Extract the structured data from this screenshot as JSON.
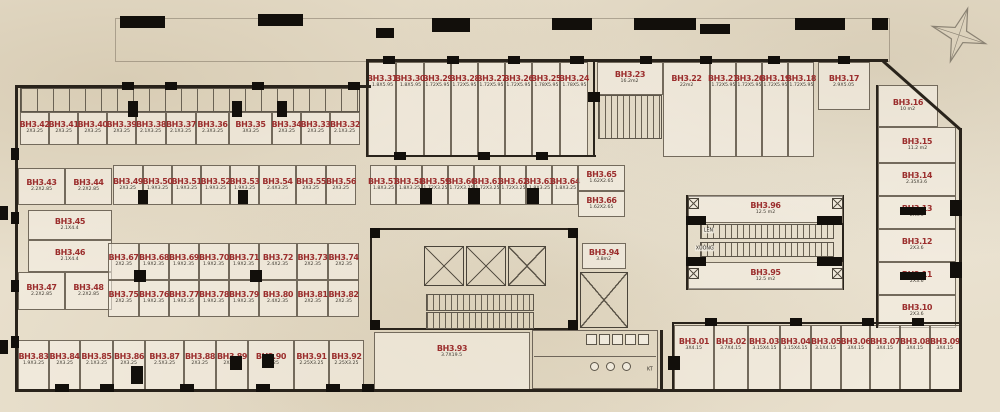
{
  "plan_name": "basement-storage-floor-plan",
  "colors": {
    "unit_label": "#9b2e2d",
    "dim_label": "#3d382f",
    "wall": "#29231b",
    "paper": "#e8dfcc"
  },
  "labels": {
    "escalator_up": "LÊN",
    "escalator_down": "XUỐNG",
    "kt": "KT"
  },
  "units": [
    {
      "id": "BH3.31",
      "dim": "1.8X5.95",
      "x": 368,
      "y": 62,
      "w": 28,
      "h": 95
    },
    {
      "id": "BH3.30",
      "dim": "1.8X5.95",
      "x": 396,
      "y": 62,
      "w": 28,
      "h": 95
    },
    {
      "id": "BH3.29",
      "dim": "1.72X5.95",
      "x": 424,
      "y": 62,
      "w": 27,
      "h": 95
    },
    {
      "id": "BH3.28",
      "dim": "1.72X5.95",
      "x": 451,
      "y": 62,
      "w": 27,
      "h": 95
    },
    {
      "id": "BH3.27",
      "dim": "1.72X5.95",
      "x": 478,
      "y": 62,
      "w": 27,
      "h": 95
    },
    {
      "id": "BH3.26",
      "dim": "1.72X5.95",
      "x": 505,
      "y": 62,
      "w": 27,
      "h": 95
    },
    {
      "id": "BH3.25",
      "dim": "1.78X5.95",
      "x": 532,
      "y": 62,
      "w": 28,
      "h": 95
    },
    {
      "id": "BH3.24",
      "dim": "1.78X5.95",
      "x": 560,
      "y": 62,
      "w": 28,
      "h": 95
    },
    {
      "id": "BH3.23",
      "dim": "16.2m2",
      "x": 597,
      "y": 62,
      "w": 66,
      "h": 33
    },
    {
      "id": "BH3.22",
      "dim": "22m2",
      "x": 663,
      "y": 62,
      "w": 47,
      "h": 95
    },
    {
      "id": "BH3.21",
      "dim": "1.72X5.95",
      "x": 710,
      "y": 62,
      "w": 26,
      "h": 95
    },
    {
      "id": "BH3.20",
      "dim": "1.72X5.95",
      "x": 736,
      "y": 62,
      "w": 26,
      "h": 95
    },
    {
      "id": "BH3.19",
      "dim": "1.72X5.95",
      "x": 762,
      "y": 62,
      "w": 26,
      "h": 95
    },
    {
      "id": "BH3.18",
      "dim": "1.72X5.95",
      "x": 788,
      "y": 62,
      "w": 26,
      "h": 95
    },
    {
      "id": "BH3.17",
      "dim": "2.9X5.05",
      "x": 818,
      "y": 62,
      "w": 52,
      "h": 48
    },
    {
      "id": "BH3.16",
      "dim": "10 m2",
      "x": 878,
      "y": 85,
      "w": 60,
      "h": 42
    },
    {
      "id": "BH3.15",
      "dim": "11.2 m2",
      "x": 878,
      "y": 127,
      "w": 78,
      "h": 36
    },
    {
      "id": "BH3.14",
      "dim": "2.35X3.6",
      "x": 878,
      "y": 163,
      "w": 78,
      "h": 33
    },
    {
      "id": "BH3.13",
      "dim": "2X3.6",
      "x": 878,
      "y": 196,
      "w": 78,
      "h": 33
    },
    {
      "id": "BH3.12",
      "dim": "2X3.6",
      "x": 878,
      "y": 229,
      "w": 78,
      "h": 33
    },
    {
      "id": "BH3.11",
      "dim": "2X3.6",
      "x": 878,
      "y": 262,
      "w": 78,
      "h": 33
    },
    {
      "id": "BH3.10",
      "dim": "2X3.6",
      "x": 878,
      "y": 295,
      "w": 78,
      "h": 33
    },
    {
      "id": "BH3.42",
      "dim": "2X3.25",
      "x": 20,
      "y": 112,
      "w": 29,
      "h": 33
    },
    {
      "id": "BH3.41",
      "dim": "2X3.25",
      "x": 49,
      "y": 112,
      "w": 29,
      "h": 33
    },
    {
      "id": "BH3.40",
      "dim": "2X3.25",
      "x": 78,
      "y": 112,
      "w": 29,
      "h": 33
    },
    {
      "id": "BH3.39",
      "dim": "2X3.25",
      "x": 107,
      "y": 112,
      "w": 29,
      "h": 33
    },
    {
      "id": "BH3.38",
      "dim": "2.1X3.25",
      "x": 136,
      "y": 112,
      "w": 30,
      "h": 33
    },
    {
      "id": "BH3.37",
      "dim": "2.1X3.25",
      "x": 166,
      "y": 112,
      "w": 30,
      "h": 33
    },
    {
      "id": "BH3.36",
      "dim": "2.3X3.25",
      "x": 196,
      "y": 112,
      "w": 33,
      "h": 33
    },
    {
      "id": "BH3.35",
      "dim": "3X3.25",
      "x": 229,
      "y": 112,
      "w": 43,
      "h": 33
    },
    {
      "id": "BH3.34",
      "dim": "2X3.25",
      "x": 272,
      "y": 112,
      "w": 29,
      "h": 33
    },
    {
      "id": "BH3.33",
      "dim": "2X3.25",
      "x": 301,
      "y": 112,
      "w": 29,
      "h": 33
    },
    {
      "id": "BH3.32",
      "dim": "2.1X3.25",
      "x": 330,
      "y": 112,
      "w": 30,
      "h": 33
    },
    {
      "id": "BH3.43",
      "dim": "2.2X2.85",
      "x": 18,
      "y": 168,
      "w": 47,
      "h": 37
    },
    {
      "id": "BH3.44",
      "dim": "2.2X2.85",
      "x": 65,
      "y": 168,
      "w": 47,
      "h": 37
    },
    {
      "id": "BH3.45",
      "dim": "2.1X4.4",
      "x": 28,
      "y": 210,
      "w": 84,
      "h": 30
    },
    {
      "id": "BH3.46",
      "dim": "2.1X4.4",
      "x": 28,
      "y": 240,
      "w": 84,
      "h": 32
    },
    {
      "id": "BH3.47",
      "dim": "2.2X2.85",
      "x": 18,
      "y": 272,
      "w": 47,
      "h": 38
    },
    {
      "id": "BH3.48",
      "dim": "2.2X2.85",
      "x": 65,
      "y": 272,
      "w": 47,
      "h": 38
    },
    {
      "id": "BH3.49",
      "dim": "2X3.25",
      "x": 113,
      "y": 165,
      "w": 30,
      "h": 40
    },
    {
      "id": "BH3.50",
      "dim": "1.9X3.25",
      "x": 143,
      "y": 165,
      "w": 29,
      "h": 40
    },
    {
      "id": "BH3.51",
      "dim": "1.9X3.25",
      "x": 172,
      "y": 165,
      "w": 29,
      "h": 40
    },
    {
      "id": "BH3.52",
      "dim": "1.9X3.25",
      "x": 201,
      "y": 165,
      "w": 29,
      "h": 40
    },
    {
      "id": "BH3.53",
      "dim": "1.9X3.25",
      "x": 230,
      "y": 165,
      "w": 29,
      "h": 40
    },
    {
      "id": "BH3.54",
      "dim": "2.4X3.25",
      "x": 259,
      "y": 165,
      "w": 37,
      "h": 40
    },
    {
      "id": "BH3.55",
      "dim": "2X3.25",
      "x": 296,
      "y": 165,
      "w": 30,
      "h": 40
    },
    {
      "id": "BH3.56",
      "dim": "2X3.25",
      "x": 326,
      "y": 165,
      "w": 30,
      "h": 40
    },
    {
      "id": "BH3.57",
      "dim": "1.8X3.25",
      "x": 370,
      "y": 165,
      "w": 26,
      "h": 40
    },
    {
      "id": "BH3.58",
      "dim": "1.8X3.25",
      "x": 396,
      "y": 165,
      "w": 26,
      "h": 40
    },
    {
      "id": "BH3.59",
      "dim": "1.72X3.25",
      "x": 422,
      "y": 165,
      "w": 26,
      "h": 40
    },
    {
      "id": "BH3.60",
      "dim": "1.72X3.25",
      "x": 448,
      "y": 165,
      "w": 26,
      "h": 40
    },
    {
      "id": "BH3.61",
      "dim": "1.72X3.25",
      "x": 474,
      "y": 165,
      "w": 26,
      "h": 40
    },
    {
      "id": "BH3.62",
      "dim": "1.72X3.25",
      "x": 500,
      "y": 165,
      "w": 26,
      "h": 40
    },
    {
      "id": "BH3.63",
      "dim": "1.8X3.25",
      "x": 526,
      "y": 165,
      "w": 26,
      "h": 40
    },
    {
      "id": "BH3.64",
      "dim": "1.8X3.25",
      "x": 552,
      "y": 165,
      "w": 26,
      "h": 40
    },
    {
      "id": "BH3.65",
      "dim": "1.62X2.65",
      "x": 578,
      "y": 165,
      "w": 47,
      "h": 26
    },
    {
      "id": "BH3.66",
      "dim": "1.62X2.65",
      "x": 578,
      "y": 191,
      "w": 47,
      "h": 26
    },
    {
      "id": "BH3.67",
      "dim": "2X2.35",
      "x": 108,
      "y": 243,
      "w": 31,
      "h": 37
    },
    {
      "id": "BH3.68",
      "dim": "1.9X2.35",
      "x": 139,
      "y": 243,
      "w": 30,
      "h": 37
    },
    {
      "id": "BH3.69",
      "dim": "1.9X2.35",
      "x": 169,
      "y": 243,
      "w": 30,
      "h": 37
    },
    {
      "id": "BH3.70",
      "dim": "1.9X2.35",
      "x": 199,
      "y": 243,
      "w": 30,
      "h": 37
    },
    {
      "id": "BH3.71",
      "dim": "1.9X2.35",
      "x": 229,
      "y": 243,
      "w": 30,
      "h": 37
    },
    {
      "id": "BH3.72",
      "dim": "2.4X2.35",
      "x": 259,
      "y": 243,
      "w": 38,
      "h": 37
    },
    {
      "id": "BH3.73",
      "dim": "2X2.35",
      "x": 297,
      "y": 243,
      "w": 31,
      "h": 37
    },
    {
      "id": "BH3.74",
      "dim": "2X2.35",
      "x": 328,
      "y": 243,
      "w": 31,
      "h": 37
    },
    {
      "id": "BH3.75",
      "dim": "2X2.35",
      "x": 108,
      "y": 280,
      "w": 31,
      "h": 37
    },
    {
      "id": "BH3.76",
      "dim": "1.9X2.35",
      "x": 139,
      "y": 280,
      "w": 30,
      "h": 37
    },
    {
      "id": "BH3.77",
      "dim": "1.9X2.35",
      "x": 169,
      "y": 280,
      "w": 30,
      "h": 37
    },
    {
      "id": "BH3.78",
      "dim": "1.9X2.35",
      "x": 199,
      "y": 280,
      "w": 30,
      "h": 37
    },
    {
      "id": "BH3.79",
      "dim": "1.9X2.35",
      "x": 229,
      "y": 280,
      "w": 30,
      "h": 37
    },
    {
      "id": "BH3.80",
      "dim": "2.4X2.35",
      "x": 259,
      "y": 280,
      "w": 38,
      "h": 37
    },
    {
      "id": "BH3.81",
      "dim": "2X2.35",
      "x": 297,
      "y": 280,
      "w": 31,
      "h": 37
    },
    {
      "id": "BH3.82",
      "dim": "2X2.35",
      "x": 328,
      "y": 280,
      "w": 31,
      "h": 37
    },
    {
      "id": "BH3.83",
      "dim": "1.9X3.25",
      "x": 18,
      "y": 340,
      "w": 31,
      "h": 50
    },
    {
      "id": "BH3.84",
      "dim": "2X3.25",
      "x": 49,
      "y": 340,
      "w": 31,
      "h": 50
    },
    {
      "id": "BH3.85",
      "dim": "2.1X3.25",
      "x": 80,
      "y": 340,
      "w": 33,
      "h": 50
    },
    {
      "id": "BH3.86",
      "dim": "2X3.25",
      "x": 113,
      "y": 340,
      "w": 32,
      "h": 50
    },
    {
      "id": "BH3.87",
      "dim": "2.5X3.25",
      "x": 145,
      "y": 340,
      "w": 39,
      "h": 50
    },
    {
      "id": "BH3.88",
      "dim": "2X3.25",
      "x": 184,
      "y": 340,
      "w": 32,
      "h": 50
    },
    {
      "id": "BH3.89",
      "dim": "2X3.25",
      "x": 216,
      "y": 340,
      "w": 32,
      "h": 50
    },
    {
      "id": "BH3.90",
      "dim": "3X3.25",
      "x": 248,
      "y": 340,
      "w": 46,
      "h": 50
    },
    {
      "id": "BH3.91",
      "dim": "2.25X3.25",
      "x": 294,
      "y": 340,
      "w": 35,
      "h": 50
    },
    {
      "id": "BH3.92",
      "dim": "2.25X3.25",
      "x": 329,
      "y": 340,
      "w": 35,
      "h": 50
    },
    {
      "id": "BH3.93",
      "dim": "3.7X19.5",
      "x": 374,
      "y": 332,
      "w": 156,
      "h": 58
    },
    {
      "id": "BH3.94",
      "dim": "3.8m2",
      "x": 582,
      "y": 243,
      "w": 44,
      "h": 26
    },
    {
      "id": "BH3.96",
      "dim": "12.5 m2",
      "x": 688,
      "y": 195,
      "w": 155,
      "h": 28
    },
    {
      "id": "BH3.95",
      "dim": "12.5 m2",
      "x": 688,
      "y": 262,
      "w": 155,
      "h": 28
    },
    {
      "id": "BH3.01",
      "dim": "3X4.15",
      "x": 674,
      "y": 325,
      "w": 40,
      "h": 66
    },
    {
      "id": "BH3.02",
      "dim": "3.7X4.15",
      "x": 714,
      "y": 325,
      "w": 34,
      "h": 66
    },
    {
      "id": "BH3.03",
      "dim": "3.15X4.15",
      "x": 748,
      "y": 325,
      "w": 32,
      "h": 66
    },
    {
      "id": "BH3.04",
      "dim": "3.15X4.15",
      "x": 780,
      "y": 325,
      "w": 31,
      "h": 66
    },
    {
      "id": "BH3.05",
      "dim": "3.1X4.15",
      "x": 811,
      "y": 325,
      "w": 30,
      "h": 66
    },
    {
      "id": "BH3.06",
      "dim": "3X4.15",
      "x": 841,
      "y": 325,
      "w": 29,
      "h": 66
    },
    {
      "id": "BH3.07",
      "dim": "3X4.15",
      "x": 870,
      "y": 325,
      "w": 30,
      "h": 66
    },
    {
      "id": "BH3.08",
      "dim": "3X4.15",
      "x": 900,
      "y": 325,
      "w": 30,
      "h": 66
    },
    {
      "id": "BH3.09",
      "dim": "3X4.15",
      "x": 930,
      "y": 325,
      "w": 30,
      "h": 66
    }
  ]
}
